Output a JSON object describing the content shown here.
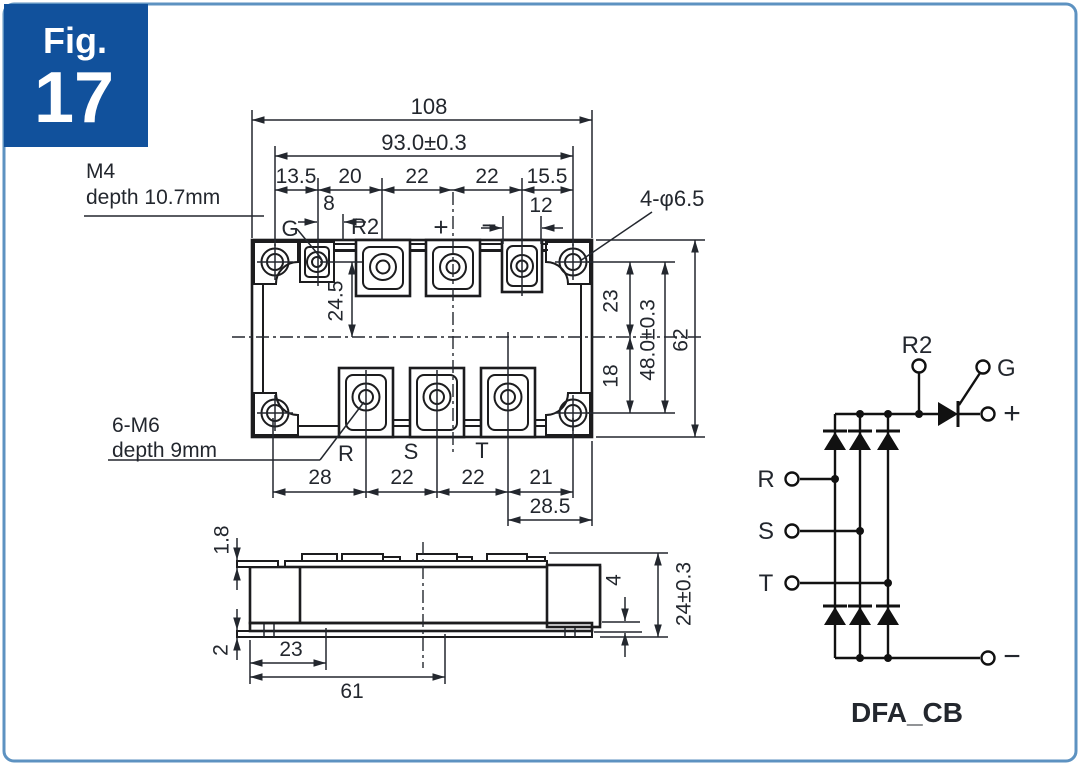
{
  "figure": {
    "label": "Fig.",
    "number": "17"
  },
  "colors": {
    "badge_blue": "#11519c",
    "border_blue": "#5d92c1",
    "line": "#1c1c1e",
    "text": "#23272e"
  },
  "notes": {
    "m4_title": "M4",
    "m4_depth": "depth 10.7mm",
    "m6_title": "6-M6",
    "m6_depth": "depth 9mm",
    "corner_holes": "4-φ6.5"
  },
  "top_view": {
    "overall_width": "108",
    "hole_span": "93.0±0.3",
    "pitches": [
      "13.5",
      "20",
      "22",
      "22",
      "15.5"
    ],
    "gate_offset": "8",
    "minus_width": "12",
    "top_to_center": "24.5",
    "upper_half": "23",
    "lower_half": "18",
    "hole_span_vertical": "48.0±0.3",
    "overall_height": "62",
    "bottom_pitches": [
      "28",
      "22",
      "22",
      "21"
    ],
    "bottom_right": "28.5",
    "terminals": {
      "gate": "G",
      "aux": "R2",
      "plus": "+",
      "minus": "−",
      "r": "R",
      "s": "S",
      "t": "T"
    }
  },
  "side_view": {
    "flange_thickness": "1.8",
    "base_plate_thickness": "2",
    "hole_offset": "23",
    "center_offset": "61",
    "base_height": "4",
    "overall_height": "24±0.3"
  },
  "circuit": {
    "title": "DFA_CB",
    "terminals": {
      "r2": "R2",
      "gate": "G",
      "plus": "+",
      "minus": "−",
      "r": "R",
      "s": "S",
      "t": "T"
    }
  }
}
